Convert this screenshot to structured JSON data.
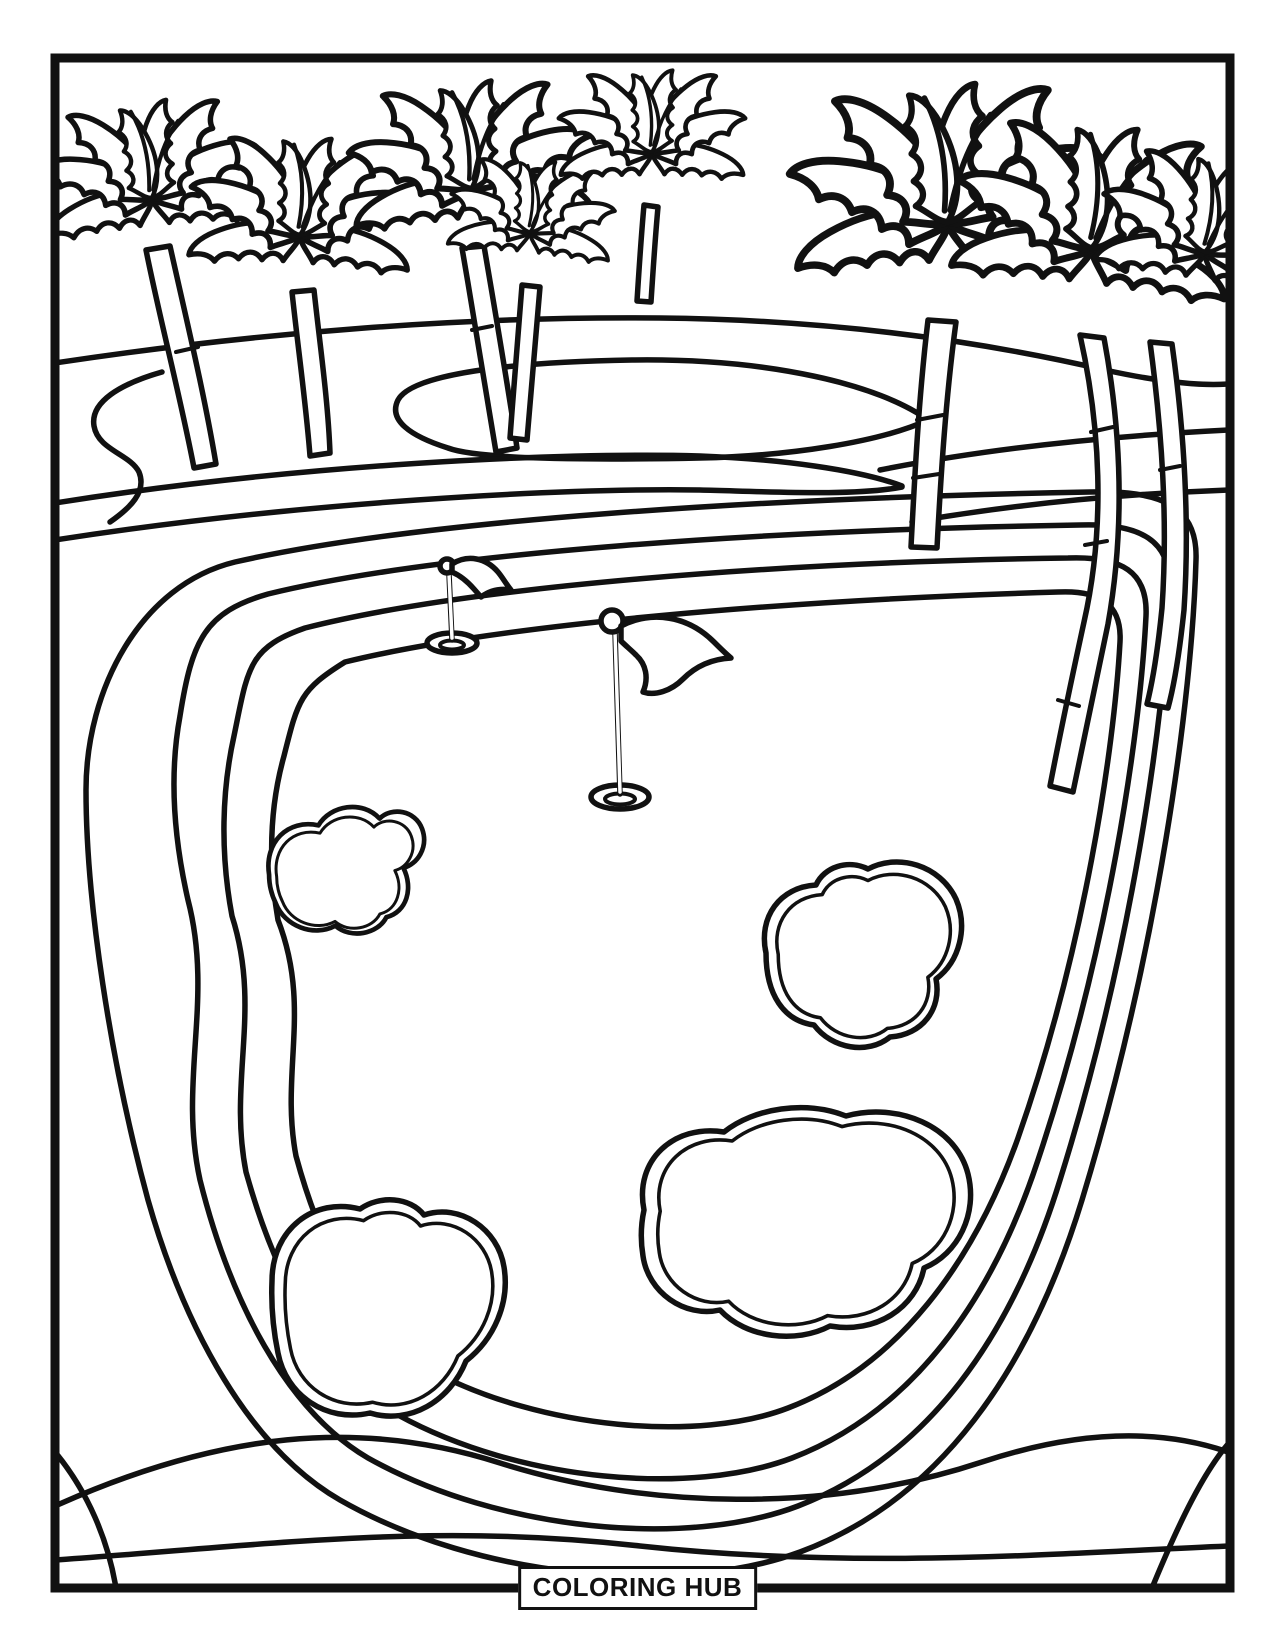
{
  "page": {
    "type": "coloring page",
    "background_color": "#ffffff",
    "line_color": "#111111"
  },
  "watermark": {
    "text": "COLORING HUB"
  },
  "scene": {
    "subject": "Golf course by the beach with palm trees, two golf flags and sand bunkers",
    "palm_trees": 8,
    "golf_flags": 2,
    "golf_holes": 2,
    "sand_bunkers": 4
  }
}
